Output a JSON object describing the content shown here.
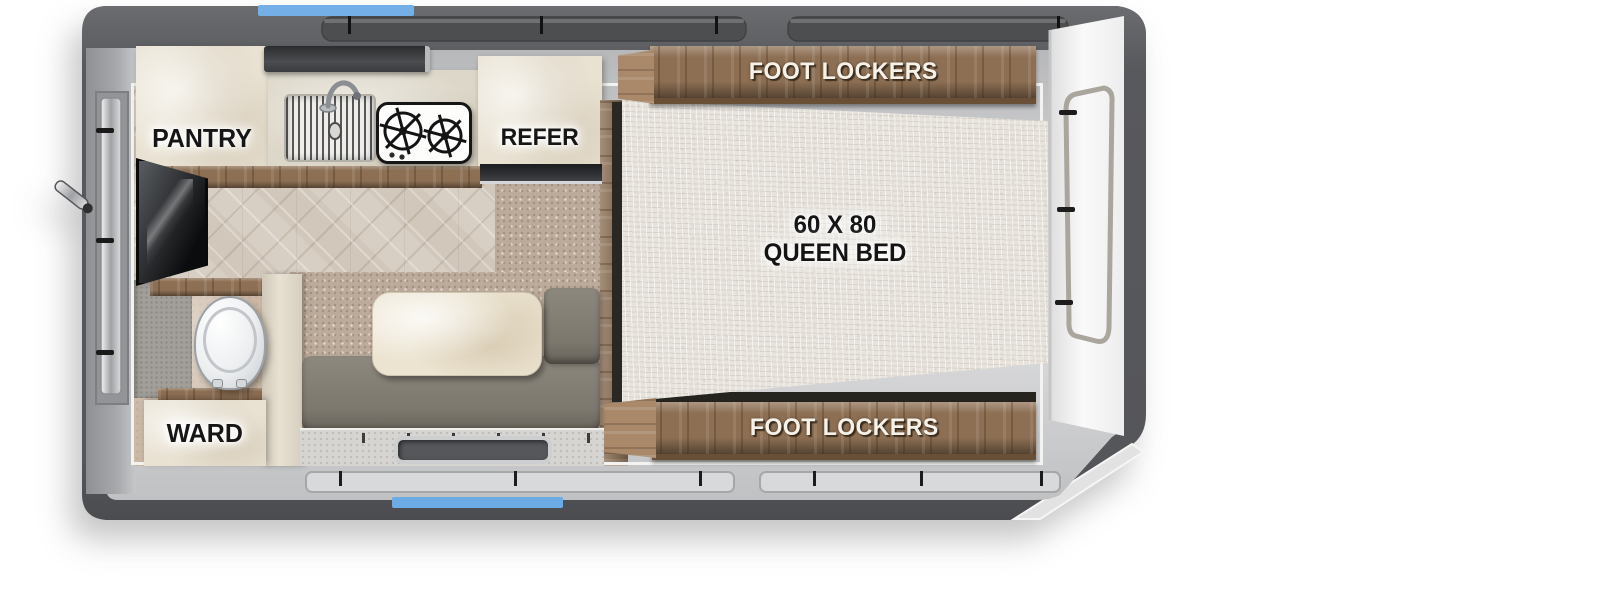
{
  "scene": {
    "type": "truck-camper floorplan, top-down view",
    "background": "#ffffff"
  },
  "colors": {
    "wall_dark_gray": "#58595c",
    "inner_wall_gray": "#cdced0",
    "accent_blue": "#74afe7",
    "wood_brown": "#8d6f53",
    "counter_cream": "#e9e2d3",
    "mattress_linen": "#e8e4dd",
    "carpet_tan": "#bcab9b",
    "bench_olive": "#847f75"
  },
  "labels": {
    "pantry": "PANTRY",
    "refer": "REFER",
    "foot_lockers_top": "FOOT LOCKERS",
    "foot_lockers_bottom": "FOOT LOCKERS",
    "bed_size": "60 X 80",
    "bed_type": "QUEEN BED",
    "wardrobe": "WARD"
  },
  "fixtures": [
    "pantry-cabinet",
    "range-hood",
    "kitchen-sink",
    "faucet",
    "two-burner-stove",
    "refrigerator",
    "queen-bed",
    "foot-lockers-top",
    "foot-lockers-bottom",
    "tv",
    "wet-bath",
    "toilet",
    "wardrobe",
    "dinette-bench",
    "dinette-table",
    "entry-step",
    "front-cap-door",
    "rear-wall-hatch",
    "corner-jack"
  ]
}
